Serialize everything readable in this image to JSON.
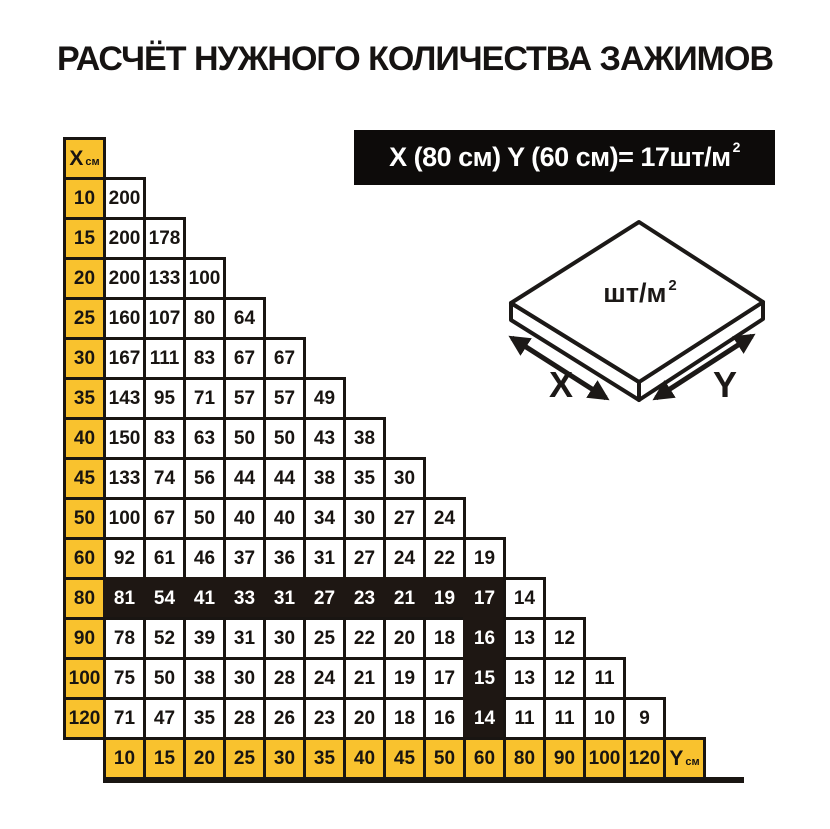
{
  "title": "РАСЧЁТ НУЖНОГО КОЛИЧЕСТВА ЗАЖИМОВ",
  "formula": {
    "text": "X (80 см) Y (60 см)= 17шт/м",
    "sup": "2"
  },
  "diagram": {
    "area_label": "шт/м",
    "area_sup": "2",
    "x_label": "X",
    "y_label": "Y"
  },
  "chart_data": {
    "type": "table",
    "title": "РАСЧЁТ НУЖНОГО КОЛИЧЕСТВА ЗАЖИМОВ",
    "unit": "шт/м²",
    "note": "X (80 см) Y (60 см)= 17шт/м²",
    "x_header": {
      "label": "X",
      "unit": "см"
    },
    "y_header": {
      "label": "Y",
      "unit": "см"
    },
    "y_categories": [
      "10",
      "15",
      "20",
      "25",
      "30",
      "35",
      "40",
      "45",
      "50",
      "60",
      "80",
      "90",
      "100",
      "120"
    ],
    "rows": [
      {
        "x": "10",
        "values": [
          200
        ]
      },
      {
        "x": "15",
        "values": [
          200,
          178
        ]
      },
      {
        "x": "20",
        "values": [
          200,
          133,
          100
        ]
      },
      {
        "x": "25",
        "values": [
          160,
          107,
          80,
          64
        ]
      },
      {
        "x": "30",
        "values": [
          167,
          111,
          83,
          67,
          67
        ]
      },
      {
        "x": "35",
        "values": [
          143,
          95,
          71,
          57,
          57,
          49
        ]
      },
      {
        "x": "40",
        "values": [
          150,
          83,
          63,
          50,
          50,
          43,
          38
        ]
      },
      {
        "x": "45",
        "values": [
          133,
          74,
          56,
          44,
          44,
          38,
          35,
          30
        ]
      },
      {
        "x": "50",
        "values": [
          100,
          67,
          50,
          40,
          40,
          34,
          30,
          27,
          24
        ]
      },
      {
        "x": "60",
        "values": [
          92,
          61,
          46,
          37,
          36,
          31,
          27,
          24,
          22,
          19
        ]
      },
      {
        "x": "80",
        "values": [
          81,
          54,
          41,
          33,
          31,
          27,
          23,
          21,
          19,
          17,
          14
        ]
      },
      {
        "x": "90",
        "values": [
          78,
          52,
          39,
          31,
          30,
          25,
          22,
          20,
          18,
          16,
          13,
          12
        ]
      },
      {
        "x": "100",
        "values": [
          75,
          50,
          38,
          30,
          28,
          24,
          21,
          19,
          17,
          15,
          13,
          12,
          11
        ]
      },
      {
        "x": "120",
        "values": [
          71,
          47,
          35,
          28,
          26,
          23,
          20,
          18,
          16,
          14,
          11,
          11,
          10,
          9
        ]
      }
    ],
    "highlight": {
      "row_x": "80",
      "col_y": "60"
    }
  },
  "colors": {
    "yellow": "#F9C22E",
    "dark": "#1E1713",
    "border": "#191512",
    "banner": "#0d0b0a"
  }
}
